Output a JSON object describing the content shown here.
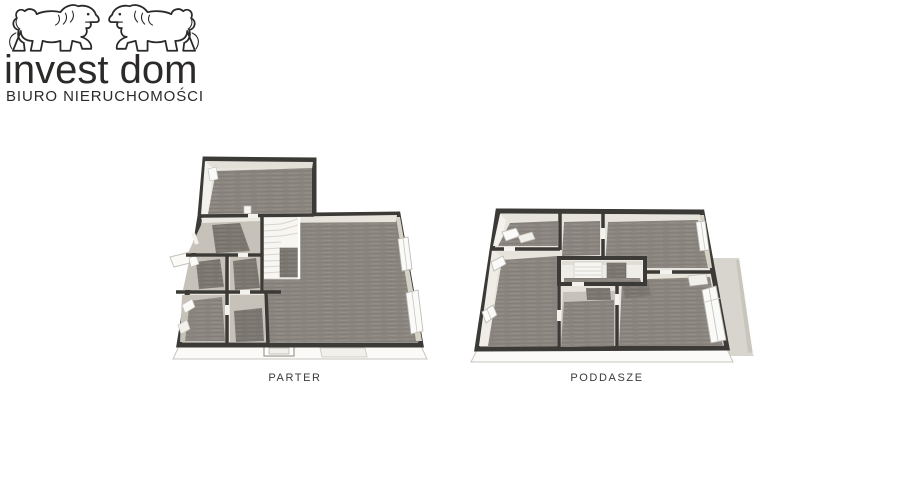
{
  "logo": {
    "title": "invest dom",
    "subtitle": "BIURO NIERUCHOMOŚCI",
    "icon": "two-lions-line-art",
    "color": "#2b2a28"
  },
  "plans": [
    {
      "id": "parter",
      "label": "PARTER",
      "type": "3d-floor-plan"
    },
    {
      "id": "poddasze",
      "label": "PODDASZE",
      "type": "3d-floor-plan"
    }
  ],
  "colors": {
    "background": "#ffffff",
    "wall": "#3c3a37",
    "carpet": "#8b8680",
    "carpet_dark": "#7c7871",
    "floor_light": "#c6c2b9",
    "wall_face_white": "#f4f2ee",
    "wall_face_cream": "#e6e3da",
    "wall_face_shade": "#d6d3c6",
    "terrace": "#d8d5ce",
    "label_text": "#3b3a38"
  }
}
